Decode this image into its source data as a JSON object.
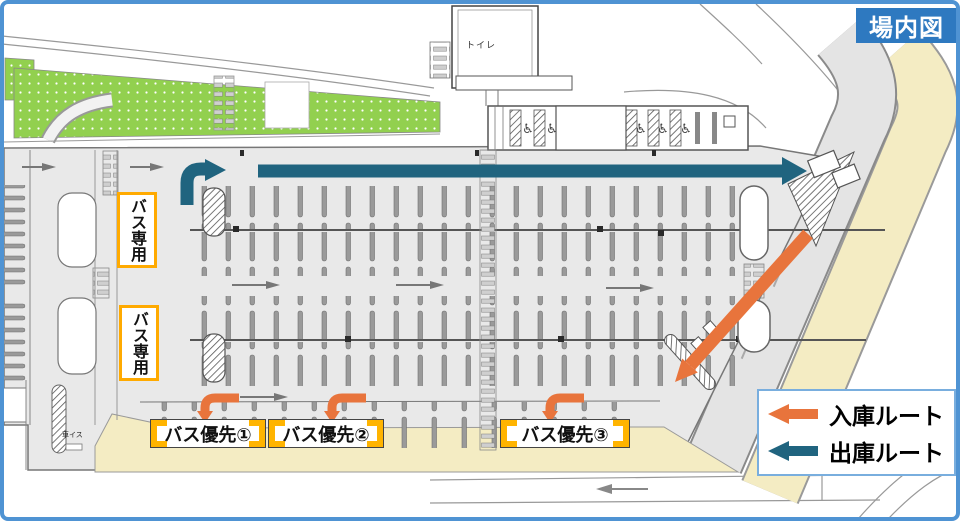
{
  "title_badge": {
    "label": "場内図"
  },
  "map_labels": {
    "toilet": "トイレ",
    "bus_only": "バス専用",
    "bus_priority": [
      "バス優先①",
      "バス優先②",
      "バス優先③"
    ],
    "wheelchair_text": "車イス"
  },
  "icons": {
    "wheelchair": "♿"
  },
  "legend": {
    "entries": [
      {
        "name": "entry-route",
        "label": "入庫ルート",
        "color": "#e8743c"
      },
      {
        "name": "exit-route",
        "label": "出庫ルート",
        "color": "#20647f"
      }
    ]
  },
  "colors": {
    "frame_blue": "#4f93d3",
    "badge_blue": "#2e79c0",
    "accent_orange": "#e8743c",
    "accent_teal": "#20647f",
    "highlight_yellow": "#ffb400",
    "green_area": "#92d04f",
    "sidewalk_beige": "#f4ecc3",
    "lot_gray": "#e9e9e9"
  }
}
